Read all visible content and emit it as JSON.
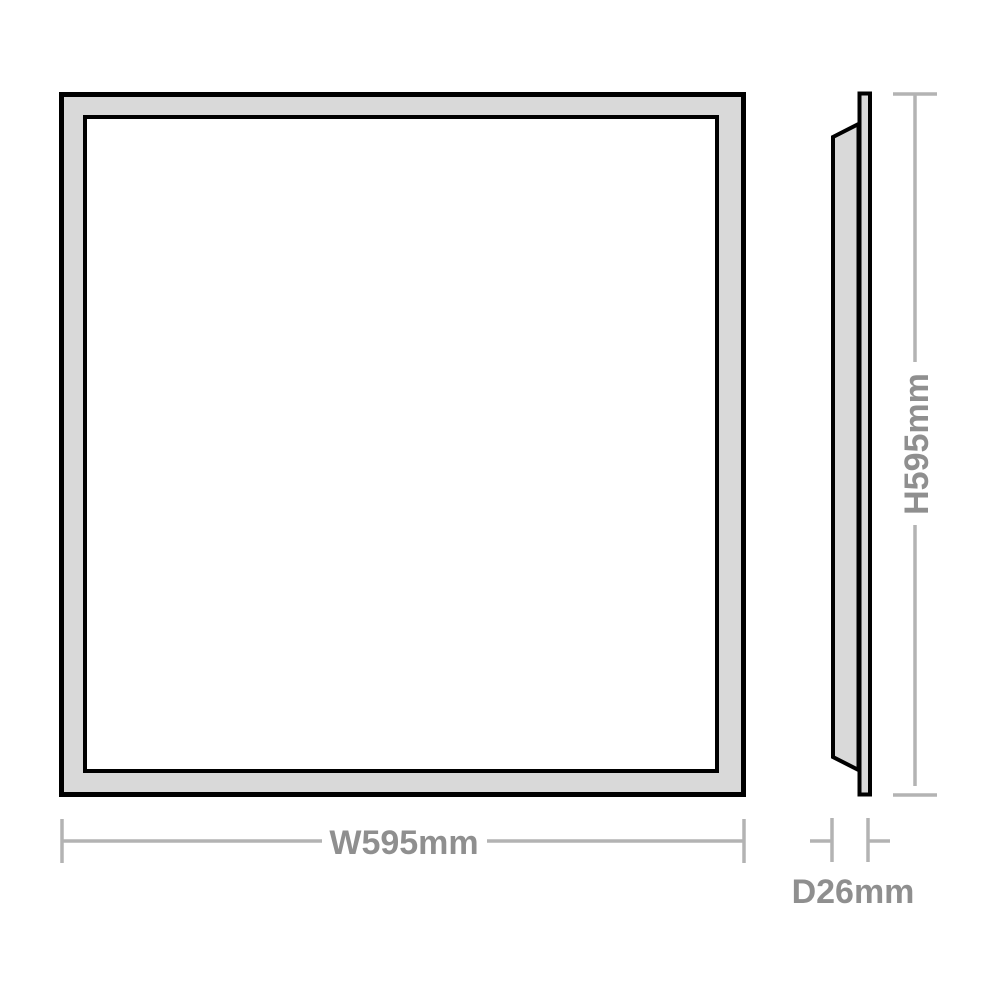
{
  "diagram": {
    "title": "panel-dimension-drawing",
    "labels": {
      "width": "W595mm",
      "height": "H595mm",
      "depth": "D26mm"
    },
    "colors": {
      "background": "#ffffff",
      "panel_fill": "#d9d9d9",
      "panel_outline": "#000000",
      "dimension_line": "#b3b3b3",
      "dimension_text": "#8f8f8f"
    }
  }
}
